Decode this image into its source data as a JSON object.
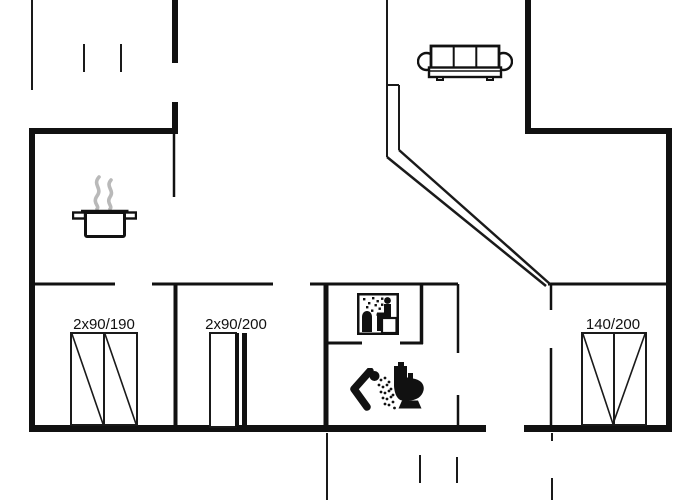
{
  "canvas": {
    "width": 700,
    "height": 500,
    "background": "#ffffff"
  },
  "style": {
    "wall_color": "#111111",
    "line_color": "#1a1a1a",
    "steam_color": "#b9b9b9",
    "label_color": "#111111",
    "label_font_size": 15
  },
  "labels": [
    {
      "id": "left-double-door-dimension",
      "text": "2x90/190",
      "x": 104,
      "y": 329
    },
    {
      "id": "middle-double-door-dimension",
      "text": "2x90/200",
      "x": 236,
      "y": 329
    },
    {
      "id": "right-window-dimension",
      "text": "140/200",
      "x": 613,
      "y": 329
    }
  ],
  "plan": {
    "thick_walls": [
      [
        29,
        128,
        6,
        304
      ],
      [
        29,
        128,
        149,
        6
      ],
      [
        172,
        0,
        6,
        63
      ],
      [
        172,
        102,
        6,
        32
      ],
      [
        525,
        0,
        6,
        134
      ],
      [
        525,
        128,
        147,
        6
      ],
      [
        666,
        128,
        6,
        304
      ],
      [
        29,
        425,
        457,
        7
      ],
      [
        524,
        425,
        148,
        7
      ]
    ],
    "thin_walls": [
      [
        174,
        134,
        174,
        197,
        2.5
      ],
      [
        33,
        284,
        115,
        284,
        3
      ],
      [
        152,
        284,
        273,
        284,
        3
      ],
      [
        310,
        284,
        458,
        284,
        3
      ],
      [
        548,
        284,
        666,
        284,
        3
      ],
      [
        175.5,
        284,
        175.5,
        425,
        4
      ],
      [
        326,
        284,
        326,
        425,
        5
      ],
      [
        421.5,
        284,
        421.5,
        344,
        3.5
      ],
      [
        328,
        343,
        362,
        343,
        3
      ],
      [
        400,
        343,
        423,
        343,
        3
      ],
      [
        458,
        284,
        458,
        353,
        2.5
      ],
      [
        458,
        395,
        458,
        425,
        2.5
      ],
      [
        551,
        284,
        551,
        310,
        2.5
      ],
      [
        551,
        348,
        551,
        427,
        2.5
      ]
    ],
    "boundary_lines": [
      [
        32,
        0,
        32,
        90,
        2
      ],
      [
        387,
        0,
        387,
        157,
        2
      ],
      [
        399,
        85,
        399,
        150,
        2
      ],
      [
        387,
        85,
        399,
        85,
        2
      ],
      [
        387,
        157,
        546,
        286,
        2.5
      ],
      [
        399,
        150,
        550,
        284,
        2.5
      ],
      [
        327,
        433,
        327,
        500,
        2
      ]
    ],
    "dash_lines": [
      [
        84,
        44,
        84,
        72,
        2
      ],
      [
        121,
        44,
        121,
        72,
        2
      ],
      [
        420,
        455,
        420,
        483,
        2
      ],
      [
        457,
        457,
        457,
        483,
        2
      ],
      [
        552,
        433,
        552,
        441,
        2
      ],
      [
        552,
        478,
        552,
        500,
        2
      ]
    ],
    "windows": [
      {
        "name": "double-door-symbol-190",
        "frame": [
          71,
          333,
          66,
          92
        ],
        "mullions": [
          [
            104,
            333,
            104,
            425
          ]
        ],
        "diagonals": [
          [
            72,
            334,
            103,
            424
          ],
          [
            105,
            334,
            136,
            424
          ]
        ],
        "bars": []
      },
      {
        "name": "sliding-door-symbol-200",
        "frame": [
          210,
          333,
          26,
          94
        ],
        "mullions": [],
        "diagonals": [],
        "bars": [
          [
            235,
            333,
            4,
            94
          ],
          [
            242,
            333,
            5,
            94
          ]
        ]
      },
      {
        "name": "window-symbol-140",
        "frame": [
          582,
          333,
          64,
          92
        ],
        "mullions": [
          [
            614,
            333,
            614,
            425
          ]
        ],
        "diagonals": [
          [
            583,
            334,
            613,
            424
          ],
          [
            645,
            334,
            613,
            424
          ]
        ],
        "bars": []
      }
    ]
  },
  "icons": [
    {
      "name": "cooking-pot-icon",
      "symbol": "pot",
      "x": 72,
      "y": 175,
      "w": 65,
      "h": 63
    },
    {
      "name": "sofa-icon",
      "symbol": "sofa",
      "x": 417,
      "y": 44,
      "w": 96,
      "h": 37
    },
    {
      "name": "sauna-icon",
      "symbol": "sauna",
      "x": 357,
      "y": 293,
      "w": 42,
      "h": 42
    },
    {
      "name": "shower-icon",
      "symbol": "shower",
      "x": 348,
      "y": 368,
      "w": 50,
      "h": 44
    },
    {
      "name": "toilet-icon",
      "symbol": "toilet",
      "x": 392,
      "y": 362,
      "w": 34,
      "h": 48
    }
  ]
}
